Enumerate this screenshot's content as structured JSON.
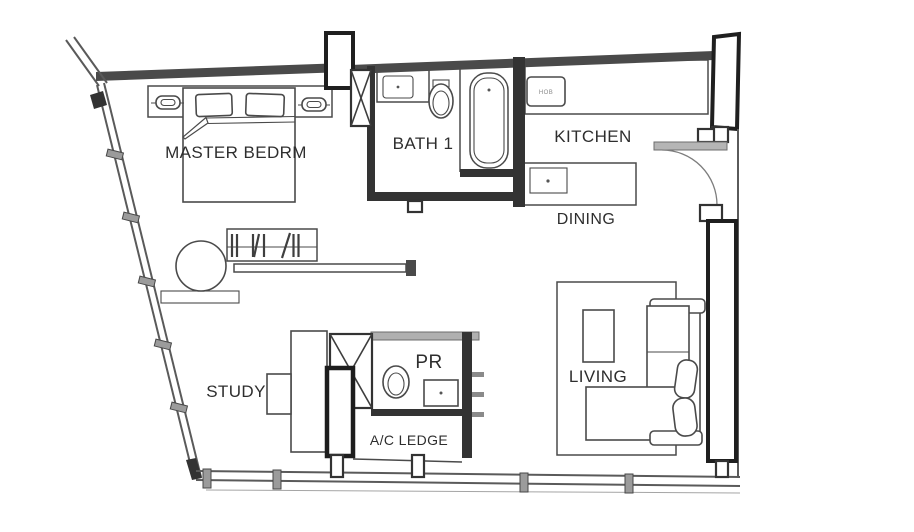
{
  "plan": {
    "type": "apartment-floor-plan",
    "rooms": {
      "master_bedroom": {
        "label": "MASTER BEDRM"
      },
      "bath1": {
        "label": "BATH 1"
      },
      "kitchen": {
        "label": "KITCHEN"
      },
      "dining": {
        "label": "DINING"
      },
      "living": {
        "label": "LIVING"
      },
      "study": {
        "label": "STUDY"
      },
      "pr": {
        "label": "PR"
      },
      "ac_ledge": {
        "label": "A/C LEDGE"
      }
    },
    "appliances": {
      "hob_label": "HOB"
    }
  },
  "colors": {
    "paper": "#ffffff",
    "ink": "#4a4a4a",
    "wall_fill": "#4a4a4a",
    "heavy": "#1f1f1f",
    "door_leaf": "#b5b5b5",
    "label": "#2e2e2e"
  }
}
